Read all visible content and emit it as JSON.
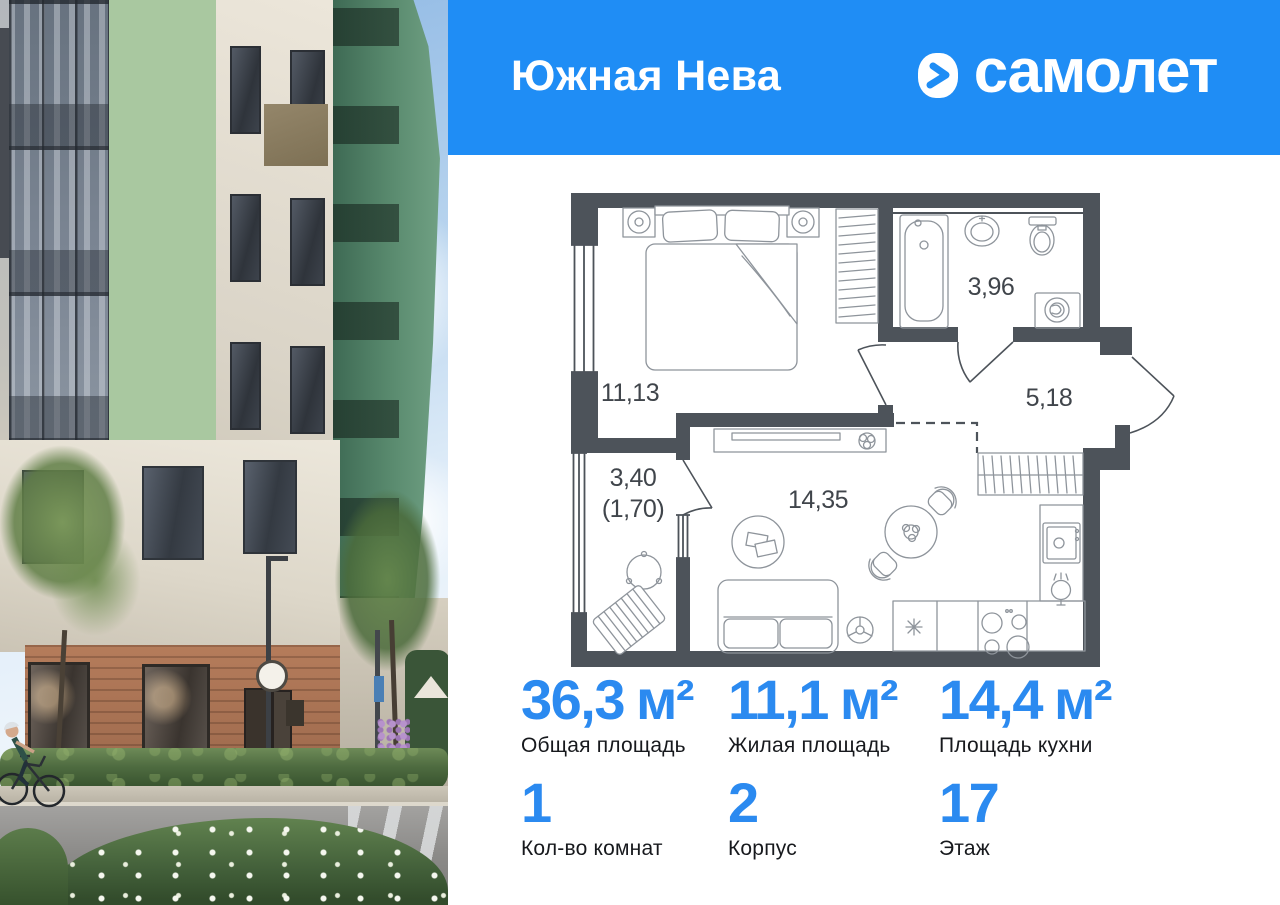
{
  "header": {
    "project_name": "Южная Нева",
    "brand_name": "самолет",
    "brand_mark_icon": "samolet-chevron-icon"
  },
  "floor_plan": {
    "rooms": [
      {
        "id": "bedroom",
        "area": "11,13"
      },
      {
        "id": "bathroom",
        "area": "3,96"
      },
      {
        "id": "hallway",
        "area": "5,18"
      },
      {
        "id": "kitchen-living",
        "area": "14,35"
      },
      {
        "id": "balcony",
        "area": "3,40",
        "area_reduced": "(1,70)"
      }
    ]
  },
  "stats": {
    "areas": [
      {
        "value": "36,3",
        "unit": "м²",
        "label": "Общая площадь"
      },
      {
        "value": "11,1",
        "unit": "м²",
        "label": "Жилая площадь"
      },
      {
        "value": "14,4",
        "unit": "м²",
        "label": "Площадь кухни"
      }
    ],
    "details": [
      {
        "value": "1",
        "label": "Кол-во комнат"
      },
      {
        "value": "2",
        "label": "Корпус"
      },
      {
        "value": "17",
        "label": "Этаж"
      }
    ]
  },
  "colors": {
    "brand_blue": "#1f8df5",
    "stat_value_blue": "#2b8af0",
    "plan_wall": "#4d535a",
    "label_dark": "#17191d"
  }
}
